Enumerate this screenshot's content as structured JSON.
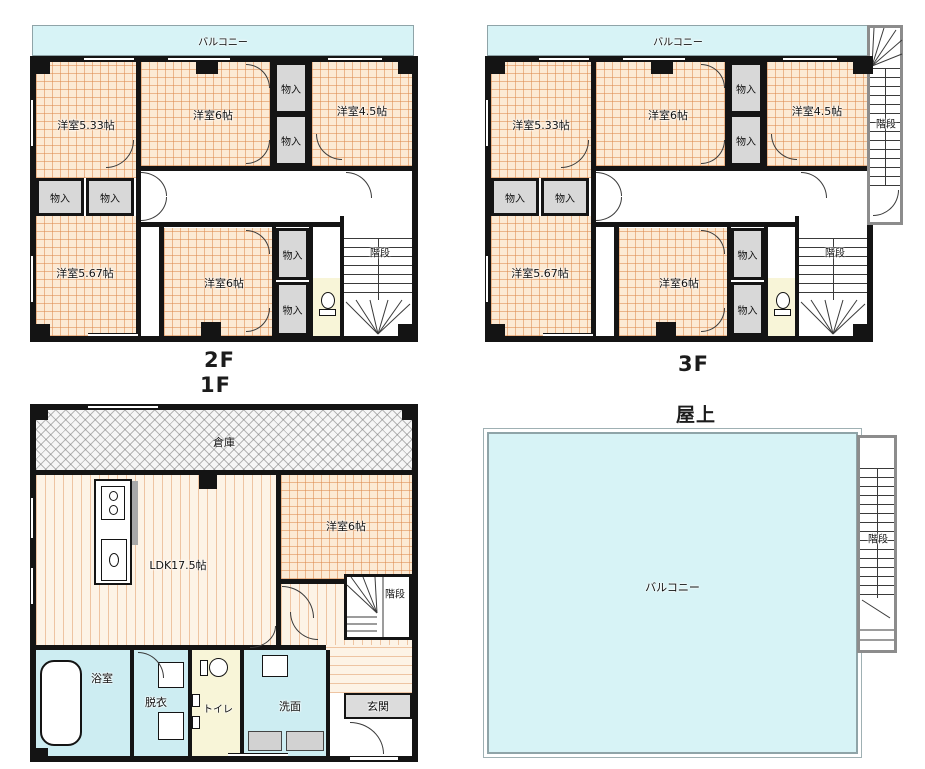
{
  "labels": {
    "balcony": "バルコニー",
    "closet": "物入",
    "stairs": "階段",
    "warehouse": "倉庫",
    "bath": "浴室",
    "dressing": "脱衣",
    "toilet": "トイレ",
    "washroom": "洗面",
    "entrance": "玄関"
  },
  "floor2": {
    "caption": "2F",
    "caption_below": "1F",
    "rooms": {
      "nw": "洋室5.33帖",
      "n": "洋室6帖",
      "ne": "洋室4.5帖",
      "sw": "洋室5.67帖",
      "s": "洋室6帖"
    }
  },
  "floor3": {
    "caption": "3F",
    "rooms": {
      "nw": "洋室5.33帖",
      "n": "洋室6帖",
      "ne": "洋室4.5帖",
      "sw": "洋室5.67帖",
      "s": "洋室6帖"
    }
  },
  "floor1": {
    "rooms": {
      "ldk": "LDK17.5帖",
      "western": "洋室6帖"
    }
  },
  "roof": {
    "caption": "屋上",
    "balcony": "バルコニー"
  },
  "colors": {
    "wall": "#141414",
    "balcony_fill": "#d7f3f6",
    "tatami_fill": "#fcead4",
    "closet_fill": "#d8d8d8",
    "toilet_fill": "#f8f5d8",
    "wet_area_fill": "#cdedf2",
    "entrance_fill": "#dcdcdc"
  }
}
